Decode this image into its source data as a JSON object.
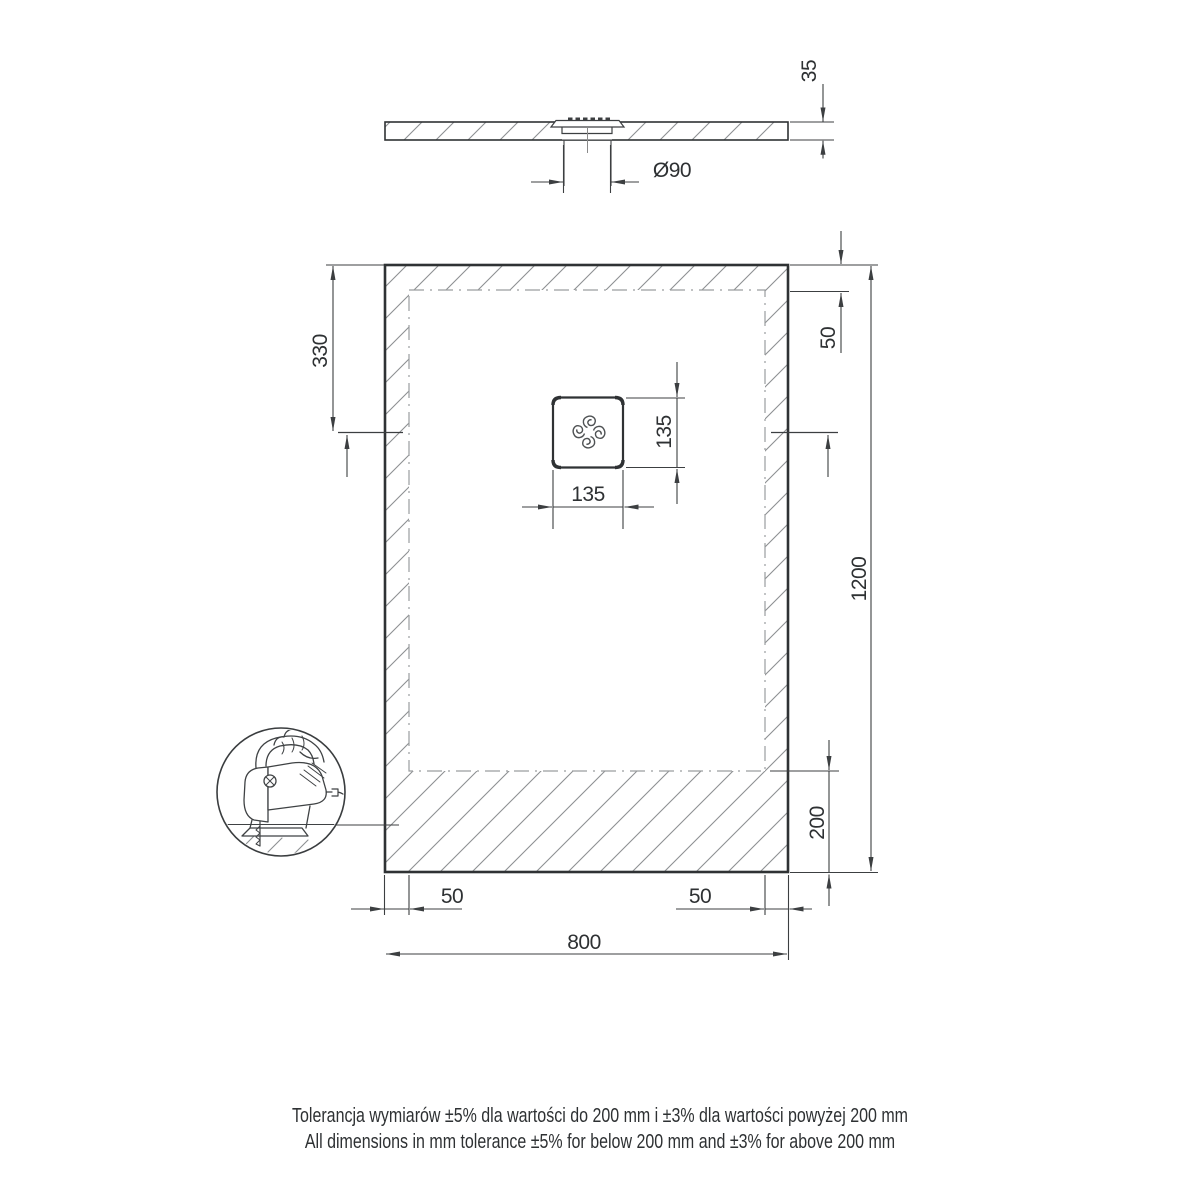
{
  "title": "Shower tray technical drawing",
  "colors": {
    "outline": "#2f3234",
    "dimension_lines": "#3c3f41",
    "hatch": "#8d9092",
    "trim_dash": "#9a9d9f",
    "text": "#2e3133"
  },
  "dims": {
    "tray_thickness": "35",
    "drain_diameter": "Ø90",
    "drain_center_from_top": "330",
    "top_trim_margin": "50",
    "drain_cover_height": "135",
    "drain_cover_width": "135",
    "tray_length": "1200",
    "bottom_trim_margin": "200",
    "left_trim_margin": "50",
    "right_trim_margin": "50",
    "tray_width": "800"
  },
  "notes": {
    "tolerance_pl": "Tolerancja wymiarów ±5% dla wartości do 200 mm i ±3% dla wartości powyżej 200 mm",
    "tolerance_en": "All dimensions in mm tolerance ±5% for below 200 mm and ±3% for above 200 mm"
  }
}
